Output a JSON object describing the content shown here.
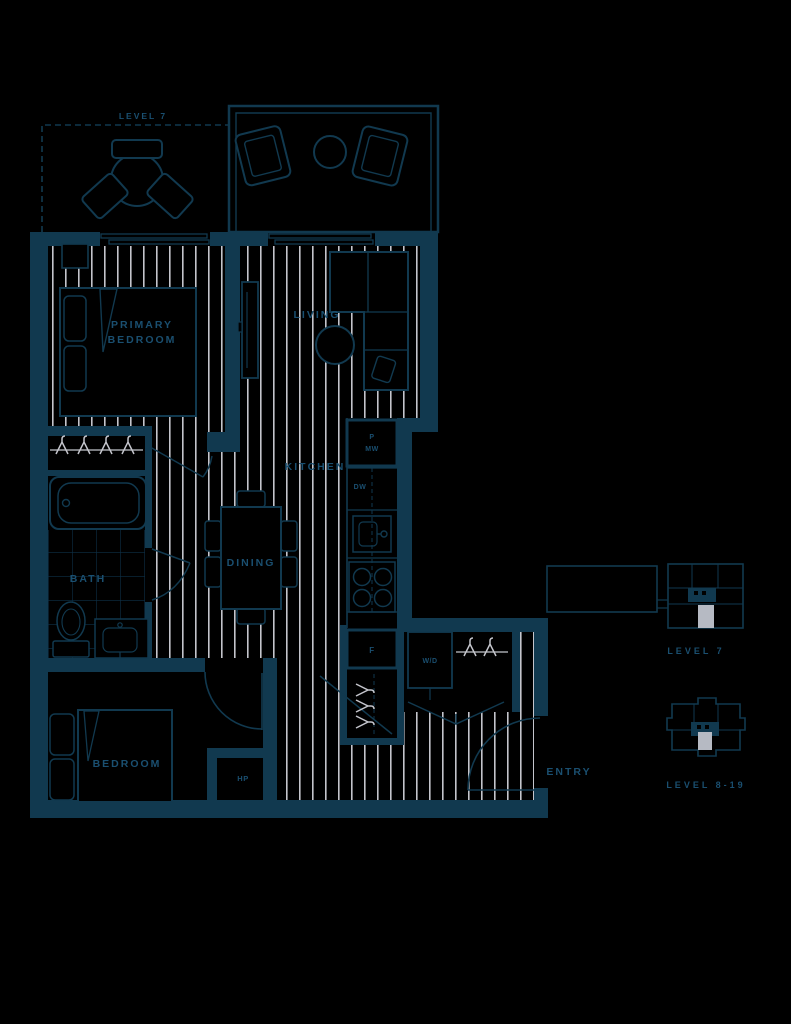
{
  "colors": {
    "background": "#000000",
    "wall": "#11394f",
    "label_text": "#1a4f70",
    "floor_stripe": "#c4c5cc",
    "tile_line": "#0d2f46",
    "keyplan_highlight": "#b6bac3"
  },
  "plan": {
    "terrace_label": "LEVEL 7",
    "rooms": {
      "primary_bedroom": [
        "PRIMARY",
        "BEDROOM"
      ],
      "living": "LIVING",
      "kitchen": "KITCHEN",
      "dining": "DINING",
      "bath": "BATH",
      "bedroom": "BEDROOM",
      "entry": "ENTRY"
    },
    "fixtures": {
      "pantry": "P",
      "microwave": "MW",
      "dishwasher": "DW",
      "fridge": "F",
      "washer_dryer": "W/D",
      "heat_pump": "HP"
    }
  },
  "keyplans": [
    {
      "label": "LEVEL 7"
    },
    {
      "label": "LEVEL 8-19"
    }
  ]
}
